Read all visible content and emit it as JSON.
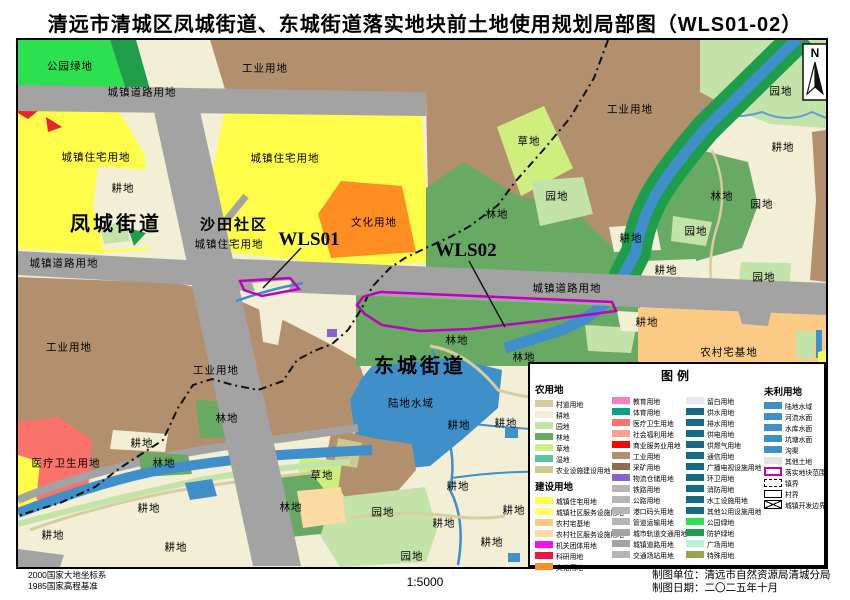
{
  "title": "清远市清城区凤城街道、东城街道落实地块前土地使用规划局部图（WLS01-02）",
  "map": {
    "north_label": "N",
    "labels": [
      {
        "t": "公园绿地",
        "x": 70,
        "y": 66
      },
      {
        "t": "工业用地",
        "x": 265,
        "y": 68
      },
      {
        "t": "城镇道路用地",
        "x": 142,
        "y": 92
      },
      {
        "t": "园地",
        "x": 781,
        "y": 91
      },
      {
        "t": "工业用地",
        "x": 630,
        "y": 109
      },
      {
        "t": "草地",
        "x": 529,
        "y": 141
      },
      {
        "t": "城镇住宅用地",
        "x": 96,
        "y": 157
      },
      {
        "t": "城镇住宅用地",
        "x": 285,
        "y": 158
      },
      {
        "t": "耕地",
        "x": 123,
        "y": 188
      },
      {
        "t": "耕地",
        "x": 783,
        "y": 147
      },
      {
        "t": "园地",
        "x": 557,
        "y": 196
      },
      {
        "t": "林地",
        "x": 497,
        "y": 214
      },
      {
        "t": "林地",
        "x": 722,
        "y": 196
      },
      {
        "t": "园地",
        "x": 762,
        "y": 204
      },
      {
        "t": "凤城街道",
        "x": 116,
        "y": 222,
        "cls": "lg"
      },
      {
        "t": "沙田社区",
        "x": 234,
        "y": 224,
        "cls": "md"
      },
      {
        "t": "城镇住宅用地",
        "x": 229,
        "y": 244
      },
      {
        "t": "WLS01",
        "x": 309,
        "y": 240,
        "cls": "wls"
      },
      {
        "t": "文化用地",
        "x": 374,
        "y": 222
      },
      {
        "t": "WLS02",
        "x": 466,
        "y": 251,
        "cls": "wls"
      },
      {
        "t": "园地",
        "x": 696,
        "y": 231
      },
      {
        "t": "耕地",
        "x": 631,
        "y": 238
      },
      {
        "t": "城镇道路用地",
        "x": 64,
        "y": 263
      },
      {
        "t": "耕地",
        "x": 666,
        "y": 270
      },
      {
        "t": "园地",
        "x": 764,
        "y": 277
      },
      {
        "t": "城镇道路用地",
        "x": 567,
        "y": 288
      },
      {
        "t": "耕地",
        "x": 647,
        "y": 322
      },
      {
        "t": "林地",
        "x": 457,
        "y": 340
      },
      {
        "t": "林地",
        "x": 524,
        "y": 357
      },
      {
        "t": "农村宅基地",
        "x": 729,
        "y": 352
      },
      {
        "t": "工业用地",
        "x": 69,
        "y": 347
      },
      {
        "t": "工业用地",
        "x": 216,
        "y": 370
      },
      {
        "t": "东城街道",
        "x": 420,
        "y": 364,
        "cls": "lg"
      },
      {
        "t": "陆地水域",
        "x": 411,
        "y": 403
      },
      {
        "t": "林地",
        "x": 227,
        "y": 418
      },
      {
        "t": "耕地",
        "x": 142,
        "y": 443
      },
      {
        "t": "医疗卫生用地",
        "x": 66,
        "y": 463
      },
      {
        "t": "林地",
        "x": 164,
        "y": 463
      },
      {
        "t": "耕地",
        "x": 459,
        "y": 425
      },
      {
        "t": "耕地",
        "x": 506,
        "y": 423
      },
      {
        "t": "草地",
        "x": 322,
        "y": 475
      },
      {
        "t": "耕地",
        "x": 458,
        "y": 486
      },
      {
        "t": "耕地",
        "x": 149,
        "y": 508
      },
      {
        "t": "林地",
        "x": 291,
        "y": 507
      },
      {
        "t": "耕地",
        "x": 514,
        "y": 510
      },
      {
        "t": "园地",
        "x": 383,
        "y": 512
      },
      {
        "t": "耕地",
        "x": 444,
        "y": 523
      },
      {
        "t": "耕地",
        "x": 53,
        "y": 535
      },
      {
        "t": "耕地",
        "x": 176,
        "y": 547
      },
      {
        "t": "耕地",
        "x": 492,
        "y": 542
      },
      {
        "t": "园地",
        "x": 412,
        "y": 556
      }
    ]
  },
  "legend": {
    "title": "图例",
    "col1": {
      "header1": "农用地",
      "items1": [
        {
          "label": "村道用地",
          "color": "#d5cb9d"
        },
        {
          "label": "耕地",
          "color": "#f2efd6"
        },
        {
          "label": "园地",
          "color": "#c3e3a9"
        },
        {
          "label": "林地",
          "color": "#68a963"
        },
        {
          "label": "草地",
          "color": "#ceef7e"
        },
        {
          "label": "湿地",
          "color": "#5ec39d"
        },
        {
          "label": "农业设施建设用地",
          "color": "#cfc98f"
        }
      ],
      "header2": "建设用地",
      "items2": [
        {
          "label": "城镇住宅用地",
          "color": "#fdfd4a"
        },
        {
          "label": "城镇社区服务设施用地",
          "color": "#fdfd6e"
        },
        {
          "label": "农村宅基地",
          "color": "#fbcb86"
        },
        {
          "label": "农村社区服务设施用地",
          "color": "#fcdaa4"
        },
        {
          "label": "机关团体用地",
          "color": "#f410f4"
        },
        {
          "label": "科研用地",
          "color": "#e8174a"
        },
        {
          "label": "文化用地",
          "color": "#fe8e21"
        }
      ]
    },
    "col2": {
      "items": [
        {
          "label": "教育用地",
          "color": "#fd7cc3"
        },
        {
          "label": "体育用地",
          "color": "#0ba181"
        },
        {
          "label": "医疗卫生用地",
          "color": "#f9736b"
        },
        {
          "label": "社会福利用地",
          "color": "#faa08d"
        },
        {
          "label": "商业服务业用地",
          "color": "#fe0000"
        },
        {
          "label": "工业用地",
          "color": "#b28f6d"
        },
        {
          "label": "采矿用地",
          "color": "#906c4e"
        },
        {
          "label": "物流仓储用地",
          "color": "#8a63d2"
        },
        {
          "label": "铁路用地",
          "color": "#b5b5b5"
        },
        {
          "label": "公路用地",
          "color": "#b5b5b5"
        },
        {
          "label": "港口码头用地",
          "color": "#b5b5b5"
        },
        {
          "label": "管道运输用地",
          "color": "#b5b5b5"
        },
        {
          "label": "城市轨道交通用地",
          "color": "#a3a3a3"
        },
        {
          "label": "城镇道路用地",
          "color": "#a3a3a3"
        },
        {
          "label": "交通场站用地",
          "color": "#b5b5b5"
        }
      ]
    },
    "col3": {
      "items": [
        {
          "label": "留白用地",
          "color": "#e8e8e8"
        },
        {
          "label": "供水用地",
          "color": "#176a85"
        },
        {
          "label": "排水用地",
          "color": "#176a85"
        },
        {
          "label": "供电用地",
          "color": "#176a85"
        },
        {
          "label": "供燃气用地",
          "color": "#176a85"
        },
        {
          "label": "通信用地",
          "color": "#176a85"
        },
        {
          "label": "广播电视设施用地",
          "color": "#176a85"
        },
        {
          "label": "环卫用地",
          "color": "#176a85"
        },
        {
          "label": "消防用地",
          "color": "#176a85"
        },
        {
          "label": "水工设施用地",
          "color": "#176a85"
        },
        {
          "label": "其他公用设施用地",
          "color": "#176a85"
        },
        {
          "label": "公园绿地",
          "color": "#2ce04f"
        },
        {
          "label": "防护绿地",
          "color": "#1e9e4b"
        },
        {
          "label": "广场用地",
          "color": "#b9f2d2"
        },
        {
          "label": "特殊用地",
          "color": "#9aa24f"
        }
      ]
    },
    "col4": {
      "header": "未利用地",
      "items": [
        {
          "label": "陆地水域",
          "color": "#3f8fca"
        },
        {
          "label": "河流水面",
          "color": "#3f8fca"
        },
        {
          "label": "水库水面",
          "color": "#3f8fca"
        },
        {
          "label": "坑塘水面",
          "color": "#3f8fca"
        },
        {
          "label": "沟渠",
          "color": "#3f8fca"
        },
        {
          "label": "其他土地",
          "color": "#e3e3e3"
        },
        {
          "label": "落实地块范围",
          "type": "sw-outline"
        },
        {
          "label": "镇界",
          "type": "sw-dashed"
        },
        {
          "label": "村界",
          "type": "sw-solid"
        },
        {
          "label": "城镇开发边界",
          "type": "sw-cross"
        }
      ]
    }
  },
  "footer": {
    "datum_line1": "2000国家大地坐标系",
    "datum_line2": "1985国家高程基准",
    "scale": "1:5000",
    "credit_line1": "制图单位：清远市自然资源局清城分局",
    "credit_line2": "制图日期：二〇二五年十月"
  },
  "colors": {
    "plot_outline": "#c000c0",
    "road_gray": "#a3a3a3",
    "water_blue": "#3f8fca",
    "boundary_black": "#111111",
    "industrial_brown": "#b28f6d",
    "residential_yellow": "#fdfd4a"
  }
}
